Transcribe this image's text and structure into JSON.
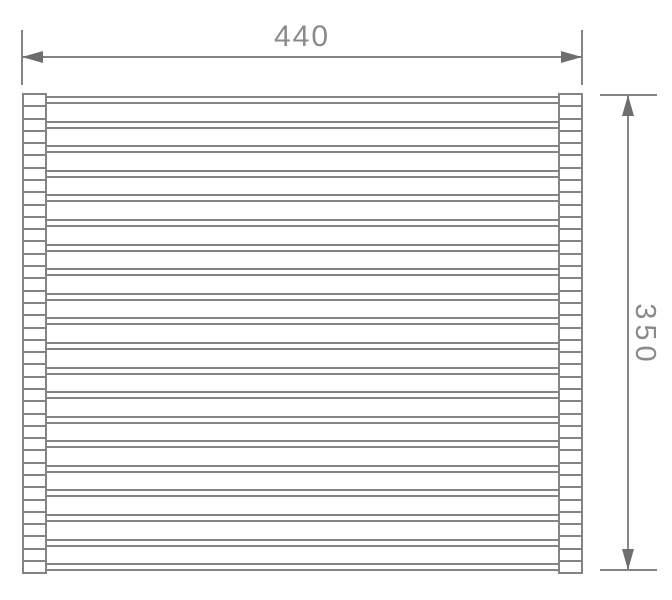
{
  "drawing": {
    "title": "roll-up rack technical drawing",
    "width_dimension": {
      "label": "440"
    },
    "height_dimension": {
      "label": "350"
    },
    "rack": {
      "rod_count": 20,
      "cap_count_per_side": 39
    },
    "colors": {
      "line": "#848484",
      "arrow": "#6e6e6e",
      "text": "#8a8a8a",
      "background": "#ffffff"
    }
  }
}
